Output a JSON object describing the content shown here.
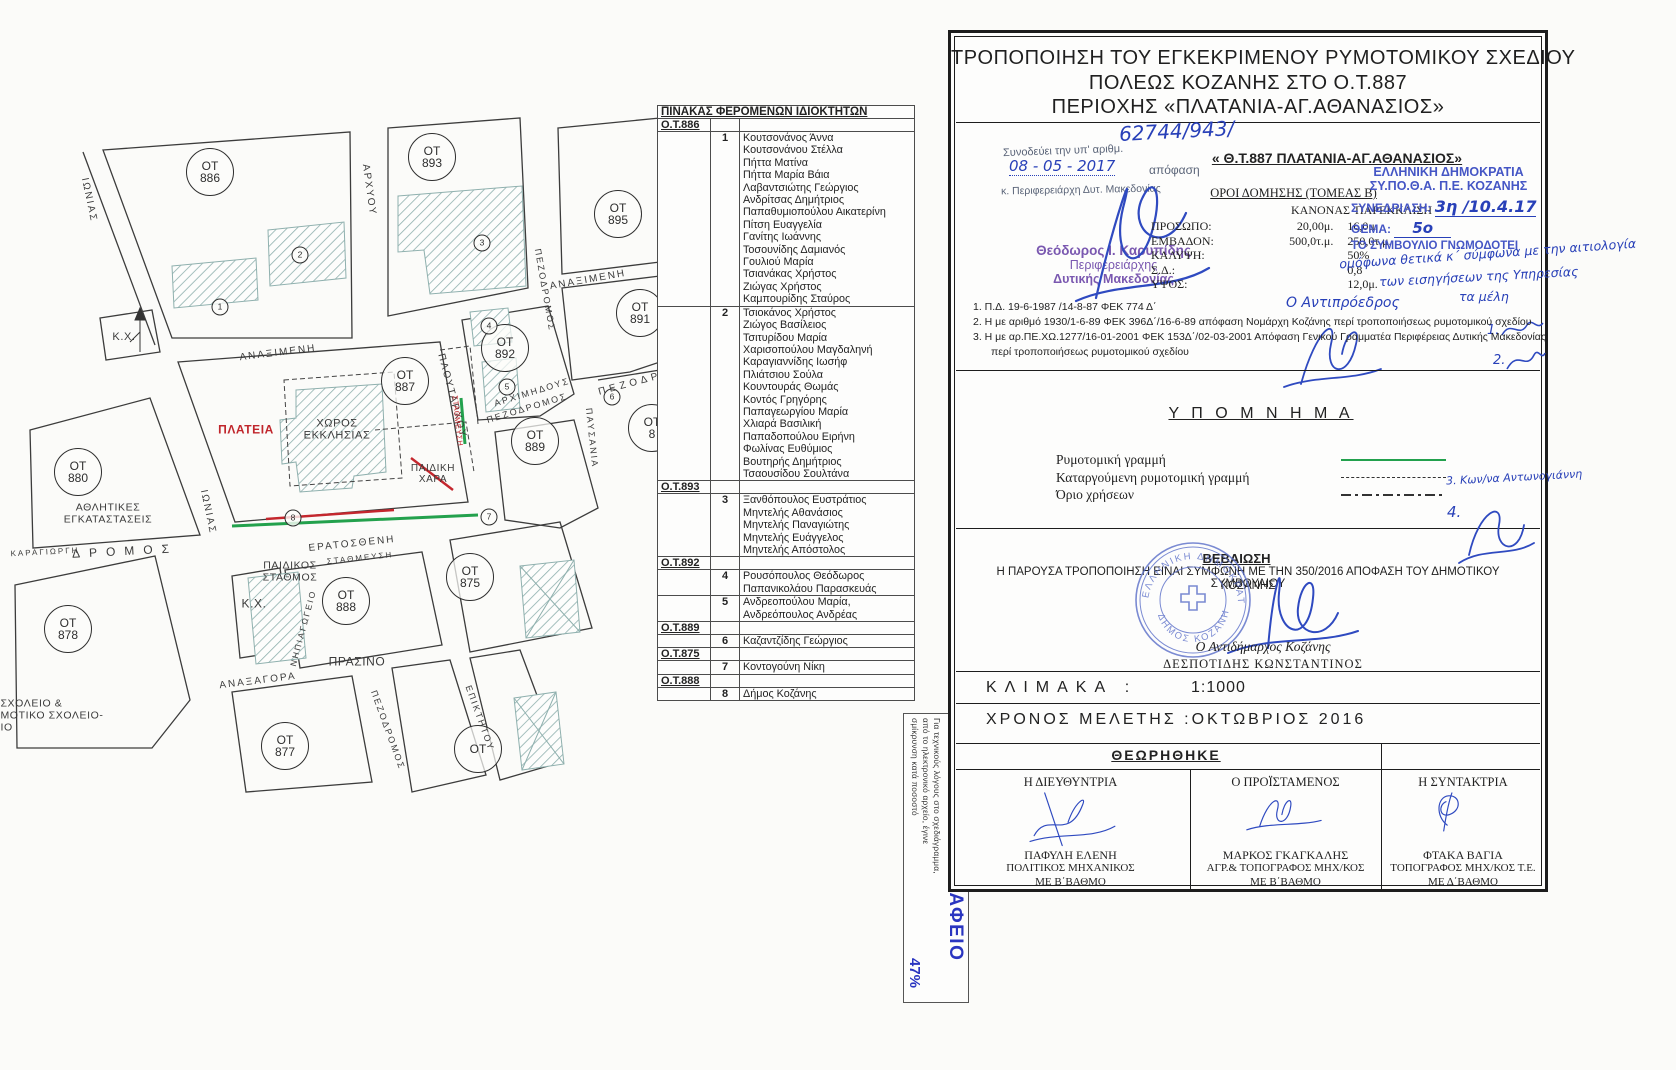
{
  "colors": {
    "accent_green": "#23a14d",
    "accent_red": "#c0262c",
    "handwriting_blue": "#2840b8",
    "stamp_blue": "#4556c5",
    "stamp_purple": "#7a58b0",
    "print_blue": "#2a35c0"
  },
  "map": {
    "ot_prefix": "ΟΤ",
    "ot_circles": [
      {
        "num": "886",
        "x": 210,
        "y": 172
      },
      {
        "num": "893",
        "x": 432,
        "y": 157
      },
      {
        "num": "895",
        "x": 618,
        "y": 214
      },
      {
        "num": "891",
        "x": 640,
        "y": 313
      },
      {
        "num": "887",
        "x": 405,
        "y": 381
      },
      {
        "num": "892",
        "x": 505,
        "y": 348
      },
      {
        "num": "889",
        "x": 535,
        "y": 441
      },
      {
        "num": "880",
        "x": 78,
        "y": 472
      },
      {
        "num": "875",
        "x": 470,
        "y": 577
      },
      {
        "num": "888",
        "x": 346,
        "y": 601
      },
      {
        "num": "878",
        "x": 68,
        "y": 629
      },
      {
        "num": "877",
        "x": 285,
        "y": 746
      },
      {
        "num": "8",
        "x": 652,
        "y": 428
      },
      {
        "num": "",
        "x": 478,
        "y": 749
      }
    ],
    "building_numbers": [
      {
        "n": "1",
        "x": 220,
        "y": 307
      },
      {
        "n": "2",
        "x": 300,
        "y": 255
      },
      {
        "n": "3",
        "x": 482,
        "y": 243
      },
      {
        "n": "4",
        "x": 489,
        "y": 326
      },
      {
        "n": "5",
        "x": 507,
        "y": 387
      },
      {
        "n": "6",
        "x": 612,
        "y": 397
      },
      {
        "n": "7",
        "x": 489,
        "y": 517
      },
      {
        "n": "8",
        "x": 293,
        "y": 518
      }
    ],
    "street_labels": [
      {
        "t": "ΙΩΝΙΑΣ",
        "x": 89,
        "y": 200,
        "r": 78
      },
      {
        "t": "ΙΩΝΙΑΣ",
        "x": 208,
        "y": 512,
        "r": 78
      },
      {
        "t": "ΑΝΑΞΙΜΕΝΗ",
        "x": 278,
        "y": 353,
        "r": -7
      },
      {
        "t": "ΑΝΑΞΙΜΕΝΗ",
        "x": 588,
        "y": 280,
        "r": -10
      },
      {
        "t": "ΑΡΧΥΟΥ",
        "x": 369,
        "y": 190,
        "r": 82
      },
      {
        "t": "ΠΛΟΥΤΑΡΧΟΥ",
        "x": 452,
        "y": 396,
        "r": 75
      },
      {
        "t": "ΑΡΧΙΜΗΔΟΥΣ",
        "x": 532,
        "y": 392,
        "r": -17,
        "s": 9
      },
      {
        "t": "ΠΕΖΟΔΡΟΜΟΣ",
        "x": 527,
        "y": 408,
        "r": -17,
        "s": 9
      },
      {
        "t": "ΠΕΖΟΔΡΟΜΟΣ",
        "x": 545,
        "y": 290,
        "r": 80,
        "s": 9
      },
      {
        "t": "ΠΕΖΟΔΡ",
        "x": 630,
        "y": 384,
        "r": -15,
        "s": 10,
        "sp": 4
      },
      {
        "t": "ΠΑΥΣΑΝΙΑ",
        "x": 592,
        "y": 438,
        "r": 84,
        "s": 9
      },
      {
        "t": "ΕΡΑΤΟΣΘΕΝΗ",
        "x": 352,
        "y": 544,
        "r": -6
      },
      {
        "t": "ΣΤΑΘΜΕΥΣΗ",
        "x": 360,
        "y": 558,
        "r": -6,
        "s": 8
      },
      {
        "t": "ΚΑΡΑΓΙΩΡΓΗ",
        "x": 45,
        "y": 552,
        "r": -3,
        "s": 8
      },
      {
        "t": "ΔΡΟΜΟΣ",
        "x": 125,
        "y": 551,
        "r": -3,
        "s": 12,
        "sp": 9
      },
      {
        "t": "ΑΝΑΞΑΓΟΡΑ",
        "x": 258,
        "y": 681,
        "r": -7
      },
      {
        "t": "ΠΕΖΟΔΡΟΜΟΣ",
        "x": 388,
        "y": 730,
        "r": 70,
        "s": 9
      },
      {
        "t": "ΕΠΙΚΤΗΤΟΥ",
        "x": 480,
        "y": 718,
        "r": 70,
        "s": 9
      },
      {
        "t": "ΝΗΠΙΑΓΩΓΕΙΟ",
        "x": 303,
        "y": 628,
        "r": -75,
        "s": 8.5
      }
    ],
    "area_labels": [
      {
        "lines": [
          "ΠΛΑΤΕΙΑ"
        ],
        "x": 246,
        "y": 430,
        "red": 1,
        "b": 1,
        "s": 12
      },
      {
        "lines": [
          "ΧΩΡΟΣ",
          "ΕΚΚΛΗΣΙΑΣ"
        ],
        "x": 337,
        "y": 430,
        "s": 11
      },
      {
        "lines": [
          "ΠΑΙΔΙΚΗ",
          "ΧΑΡΑ"
        ],
        "x": 433,
        "y": 474,
        "s": 10
      },
      {
        "lines": [
          "ΣΤΑΘΜΕΥΣΗ"
        ],
        "x": 457,
        "y": 421,
        "red": 1,
        "s": 7.5,
        "r": 84
      },
      {
        "lines": [
          "Κ.Χ."
        ],
        "x": 124,
        "y": 337,
        "s": 11
      },
      {
        "lines": [
          "Κ.Χ."
        ],
        "x": 254,
        "y": 604,
        "s": 12
      },
      {
        "lines": [
          "ΑΘΛΗΤΙΚΕΣ",
          "ΕΓΚΑΤΑΣΤΑΣΕΙΣ"
        ],
        "x": 108,
        "y": 514,
        "s": 10.5
      },
      {
        "lines": [
          "ΠΑΙΔΙΚΟΣ",
          "ΣΤΑΘΜΟΣ"
        ],
        "x": 290,
        "y": 572,
        "s": 10.5
      },
      {
        "lines": [
          "ΠΡΑΣΙΝΟ"
        ],
        "x": 357,
        "y": 662,
        "s": 12
      },
      {
        "lines": [
          "ΣΧΟΛΕΙΟ &",
          "ΜΟΤΙΚΟ ΣΧΟΛΕΙΟ-",
          "ΙΟ"
        ],
        "x": 52,
        "y": 716,
        "s": 10.5,
        "align": "left"
      }
    ]
  },
  "owners_table": {
    "title": "ΠΙΝΑΚΑΣ ΦΕΡΟΜΕΝΩΝ ΙΔΙΟΚΤΗΤΩΝ",
    "groups": [
      {
        "block": "Ο.Τ.886",
        "entries": [
          {
            "num": "1",
            "names": [
              "Κουτσονάνος Άννα",
              "Κουτσονάνου Στέλλα",
              "Πήττα Ματίνα",
              "Πήττα Μαρία Βάια",
              "Λαβαντσιώτης Γεώργιος",
              "Ανδρίτσας Δημήτριος",
              "Παπαθυμιοπούλου Αικατερίνη",
              "Πίτση Ευαγγελία",
              "Γανίτης Ιωάννης",
              "Τοσουνίδης Δαμιανός",
              "Γουλιού Μαρία",
              "Τσιανάκας Χρήστος",
              "Ζιώγας Χρήστος",
              "Καμπουρίδης Σταύρος"
            ]
          },
          {
            "num": "2",
            "names": [
              "Τσιοκάνος Χρήστος",
              "Ζιώγος Βασίλειος",
              "Τσιτυρίδου Μαρία",
              "Χαρισοπούλου Μαγδαληνή",
              "Καραγιαννίδης Ιωσήφ",
              "Πλιάτσιου Σούλα",
              "Κουντουράς Θωμάς",
              "Κοντός Γρηγόρης",
              "Παπαγεωργίου Μαρία",
              "Χλιαρά Βασιλική",
              "Παπαδοπούλου Ειρήνη",
              "Φωλίνας Ευθύμιος",
              "Βουτηρής Δημήτριος",
              "Τσαουσίδου Σουλτάνα"
            ]
          }
        ]
      },
      {
        "block": "Ο.Τ.893",
        "entries": [
          {
            "num": "3",
            "names": [
              "Ξανθόπουλος Ευστράτιος",
              "Μηντελής Αθανάσιος",
              "Μηντελής Παναγιώτης",
              "Μηντελής Ευάγγελος",
              "Μηντελής Απόστολος"
            ]
          }
        ]
      },
      {
        "block": "Ο.Τ.892",
        "entries": [
          {
            "num": "4",
            "names": [
              "Ρουσόπουλος Θεόδωρος",
              "Παπανικολάου Παρασκευάς"
            ]
          },
          {
            "num": "5",
            "names": [
              "Ανδρεοπούλου Μαρία,",
              "Ανδρεόπουλος Ανδρέας"
            ]
          }
        ]
      },
      {
        "block": "Ο.Τ.889",
        "entries": [
          {
            "num": "6",
            "names": [
              "Καζαντζίδης Γεώργιος"
            ]
          }
        ]
      },
      {
        "block": "Ο.Τ.875",
        "entries": [
          {
            "num": "7",
            "names": [
              "Κοντογούνη Νίκη"
            ]
          }
        ]
      },
      {
        "block": "Ο.Τ.888",
        "entries": [
          {
            "num": "8",
            "names": [
              "Δήμος Κοζάνης"
            ]
          }
        ]
      }
    ]
  },
  "print_note": {
    "agency": "ΕΘΝΙΚΟ ΤΥΠΟΓΡΑΦΕΙΟ",
    "lines": [
      "Για τεχνικούς λόγους στο σχεδιάγραμμα,",
      "από το ηλεκτρονικό αρχείο, έγινε",
      "σμίκρυνση κατά ποσοστό"
    ],
    "percent": "47%"
  },
  "title_block": {
    "title_lines": [
      "ΤΡΟΠΟΠΟΙΗΣΗ ΤΟΥ ΕΓΚΕΚΡΙΜΕΝΟΥ ΡΥΜΟΤΟΜΙΚΟΥ ΣΧΕΔΙΟΥ",
      "ΠΟΛΕΩΣ ΚΟΖΑΝΗΣ ΣΤΟ Ο.Τ.887",
      "ΠΕΡΙΟΧΗΣ «ΠΛΑΤΑΝΙΑ-ΑΓ.ΑΘΑΝΑΣΙΟΣ»"
    ],
    "approval": {
      "number_hw": "62744/943/",
      "stamp_line1": "Συνοδεύει την υπ' αριθμ.",
      "date_hw": "08 - 05 - 2017",
      "stamp_line2": "απόφαση",
      "stamp_line3": "κ. Περιφερειάρχη Δυτ. Μακεδονίας",
      "signer_name": "Θεόδωρος Ι. Καρυπίδης",
      "signer_role1": "Περιφερειάρχης",
      "signer_role2": "Δυτικής Μακεδονίας"
    },
    "subtitle": "« Θ.Τ.887 ΠΛΑΤΑΝΙΑ-ΑΓ.ΑΘΑΝΑΣΙΟΣ»",
    "building_terms": {
      "heading": "ΟΡΟΙ ΔΟΜΗΣΗΣ  (ΤΟΜΕΑΣ Β)",
      "col1": "ΚΑΝΟΝΑΣ",
      "col2": "ΠΑΡΕΚΚΛΙΣΗ",
      "rows": [
        {
          "label": "ΠΡΟΣΩΠΟ:",
          "v1": "20,00μ.",
          "v2": "16,0μ."
        },
        {
          "label": "ΕΜΒΑΔΟΝ:",
          "v1": "500,0τ.μ.",
          "v2": "250,0τ.μ."
        },
        {
          "label": "ΚΑΛΥΨΗ:",
          "v1": "",
          "v2": "50%"
        },
        {
          "label": "Σ.Δ.:",
          "v1": "",
          "v2": "0,8"
        },
        {
          "label": "ΥΨΟΣ:",
          "v1": "",
          "v2": "12,0μ."
        }
      ]
    },
    "committee_stamp": {
      "line1": "ΕΛΛΗΝΙΚΗ ΔΗΜΟΚΡΑΤΙΑ",
      "line2": "ΣΥ.ΠΟ.Θ.Α. Π.Ε. ΚΟΖΑΝΗΣ",
      "session_label": "ΣΥΝΕΔΡΙΑΣΗ:",
      "session_hw": "3η /10.4.17",
      "topic_label": "ΘΕΜΑ:",
      "topic_hw": "5ο",
      "line3": "ΤΟ ΣΥΜΒΟΥΛΙΟ ΓΝΩΜΟΔΟΤΕΙ",
      "hw_lines": [
        "ομόφωνα θετικά κ΄ σύμφωνα με την αιτιολογία",
        "των εισηγήσεων της Υπηρεσίας",
        "τα μέλη"
      ],
      "vice_hw": "Ο Αντιπρόεδρος",
      "member_sig_1": "1.",
      "member_sig_2": "2.",
      "member_sig_3": "3. Κων/να Αντωνογιάννη",
      "member_sig_4": "4."
    },
    "notes": [
      "1.  Π.Δ. 19-6-1987 /14-8-87  ΦΕΚ 774 Δ΄",
      "2.  Η με αριθμό 1930/1-6-89 ΦΕΚ 396Δ΄/16-6-89 απόφαση Νομάρχη Κοζάνης περί τροποποιήσεως ρυμοτομικού σχεδίου",
      "3.  Η με αρ.ΠΕ.ΧΩ.1277/16-01-2001 ΦΕΚ 153Δ΄/02-03-2001 Απόφαση Γενικού Γραμματέα Περιφέρειας Δυτικής Μακεδονίας",
      "περί τροποποιήσεως ρυμοτομικού σχεδίου"
    ],
    "legend": {
      "title": "Υ Π Ο Μ Ν Η Μ Α",
      "items": [
        {
          "label": "Ρυμοτομική γραμμή",
          "style": "solid-green"
        },
        {
          "label": "Καταργούμενη ρυμοτομική γραμμή",
          "style": "dashed-black"
        },
        {
          "label": "Όριο χρήσεων",
          "style": "dashdot-black"
        }
      ]
    },
    "certification": {
      "title": "ΒΕΒΑΙΩΣΗ",
      "text1": "Η ΠΑΡΟΥΣΑ ΤΡΟΠΟΠΟΙΗΣΗ ΕΙΝΑΙ ΣΥΜΦΩΝΗ ΜΕ ΤΗΝ 350/2016 ΑΠΟΦΑΣΗ ΤΟΥ ΔΗΜΟΤΙΚΟΥ ΣΥΜΒΟΥΛΙΟΥ",
      "text2": "ΚΟΖΑΝΗΣ",
      "stamp_top": "ΕΛΛΗΝΙΚΗ ΔΗΜΟΚΡΑΤΙΑ",
      "stamp_bottom": "ΔΗΜΟΣ ΚΟΖΑΝΗΣ",
      "signer_role": "Ο Αντιδήμαρχος Κοζάνης",
      "signer_name": "ΔΕΣΠΟΤΙΔΗΣ ΚΩΝΣΤΑΝΤΙΝΟΣ"
    },
    "scale": {
      "label": "ΚΛΙΜΑΚΑ :",
      "value": "1:1000"
    },
    "study_time": "ΧΡΟΝΟΣ ΜΕΛΕΤΗΣ :ΟΚΤΩΒΡΙΟΣ  2016",
    "approved": {
      "title": "ΘΕΩΡΗΘΗΚΕ",
      "signers": [
        {
          "role": "Η ΔΙΕΥΘΥΝΤΡΙΑ",
          "name": "ΠΑΦΥΛΗ ΕΛΕΝΗ",
          "title1": "ΠΟΛΙΤΙΚΟΣ ΜΗΧΑΝΙΚΟΣ",
          "title2": "ΜΕ Β΄ΒΑΘΜΟ"
        },
        {
          "role": "Ο ΠΡΟΪΣΤΑΜΕΝΟΣ",
          "name": "ΜΑΡΚΟΣ ΓΚΑΓΚΑΛΗΣ",
          "title1": "ΑΓΡ.& ΤΟΠΟΓΡΑΦΟΣ ΜΗΧ/ΚΟΣ",
          "title2": "ΜΕ Β΄ΒΑΘΜΟ"
        },
        {
          "role": "Η ΣΥΝΤΑΚΤΡΙΑ",
          "name": "ΦΤΑΚΑ ΒΑΓΙΑ",
          "title1": "ΤΟΠΟΓΡΑΦΟΣ ΜΗΧ/ΚΟΣ Τ.Ε.",
          "title2": "ΜΕ Δ΄ΒΑΘΜΟ"
        }
      ]
    }
  }
}
